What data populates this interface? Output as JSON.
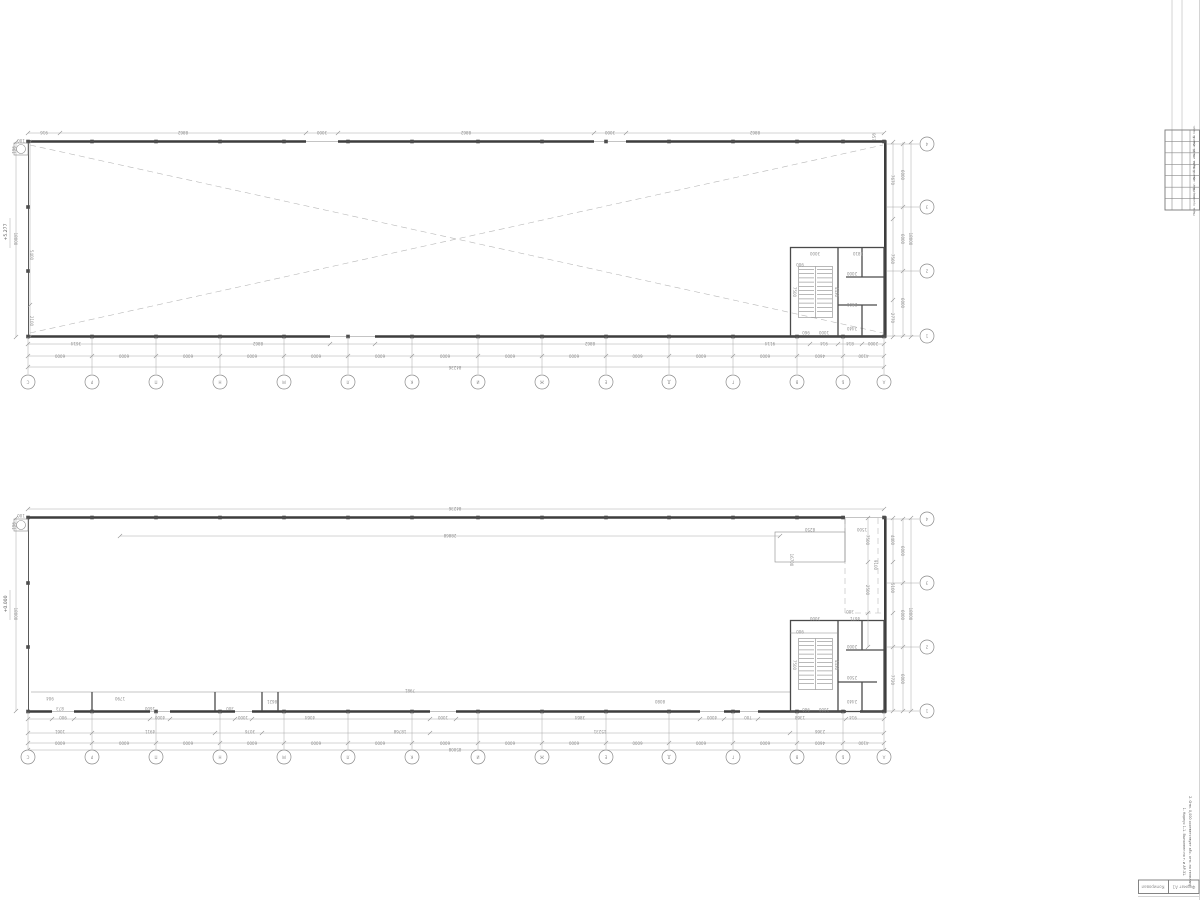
{
  "sheet": {
    "background": "#ffffff",
    "wall_color": "#3d3d3d",
    "dim_color": "#a8a8a8",
    "title": "two-storey industrial building floor plans"
  },
  "axes": {
    "horizontal_labels": [
      "С",
      "Р",
      "П",
      "Н",
      "М",
      "Л",
      "К",
      "И",
      "Ж",
      "Е",
      "Д",
      "Г",
      "В",
      "Б",
      "А"
    ],
    "vertical_labels": [
      "4",
      "3",
      "2",
      "1"
    ]
  },
  "plans": {
    "upper": {
      "name": "plan at elevation +5.277",
      "elevation": "+5.277",
      "bay_dims": [
        "6000",
        "6000",
        "6000",
        "6000",
        "6000",
        "6000",
        "6000",
        "6000",
        "6000",
        "6000",
        "6000",
        "6000",
        "4600",
        "4100"
      ],
      "side_bay_dims": [
        "6000",
        "6000",
        "6000"
      ],
      "total_width": "84236",
      "total_height": "18000",
      "dims": [
        {
          "x": 44,
          "y": 131,
          "t": "916"
        },
        {
          "x": 183,
          "y": 131,
          "t": "8862"
        },
        {
          "x": 322,
          "y": 131,
          "t": "3000"
        },
        {
          "x": 466,
          "y": 131,
          "t": "8862"
        },
        {
          "x": 610,
          "y": 131,
          "t": "3000"
        },
        {
          "x": 755,
          "y": 131,
          "t": "8862"
        },
        {
          "x": 872,
          "y": 137,
          "t": "957",
          "r": 90
        },
        {
          "x": 76,
          "y": 342,
          "t": "3614"
        },
        {
          "x": 258,
          "y": 342,
          "t": "8862"
        },
        {
          "x": 590,
          "y": 342,
          "t": "8862"
        },
        {
          "x": 770,
          "y": 342,
          "t": "9114"
        },
        {
          "x": 824,
          "y": 342,
          "t": "914"
        },
        {
          "x": 850,
          "y": 342,
          "t": "814"
        },
        {
          "x": 873,
          "y": 342,
          "t": "2000"
        },
        {
          "x": 455,
          "y": 366,
          "t": "84236"
        },
        {
          "x": 815,
          "y": 252,
          "t": "3000"
        },
        {
          "x": 858,
          "y": 252,
          "t": "1810"
        },
        {
          "x": 800,
          "y": 263,
          "t": "900"
        },
        {
          "x": 852,
          "y": 272,
          "t": "2000"
        },
        {
          "x": 852,
          "y": 303,
          "t": "2500"
        },
        {
          "x": 852,
          "y": 327,
          "t": "2440"
        },
        {
          "x": 806,
          "y": 331,
          "t": "960"
        },
        {
          "x": 824,
          "y": 331,
          "t": "1000"
        },
        {
          "x": 793,
          "y": 292,
          "t": "7500",
          "r": 90
        },
        {
          "x": 835,
          "y": 292,
          "t": "4430",
          "r": 90
        },
        {
          "x": 14,
          "y": 239,
          "t": "18000",
          "r": 90
        },
        {
          "x": 30,
          "y": 255,
          "t": "5400",
          "r": 90
        },
        {
          "x": 30,
          "y": 321,
          "t": "2100",
          "r": 90
        },
        {
          "x": 891,
          "y": 180,
          "t": "7670",
          "r": 90
        },
        {
          "x": 891,
          "y": 259,
          "t": "7560",
          "r": 90
        },
        {
          "x": 891,
          "y": 318,
          "t": "2770",
          "r": 90
        },
        {
          "x": 901,
          "y": 175,
          "t": "6000",
          "r": 90
        },
        {
          "x": 901,
          "y": 239,
          "t": "6000",
          "r": 90
        },
        {
          "x": 901,
          "y": 303,
          "t": "6000",
          "r": 90
        },
        {
          "x": 909,
          "y": 239,
          "t": "18000",
          "r": 90
        },
        {
          "x": 21,
          "y": 139,
          "t": "100"
        },
        {
          "x": 12,
          "y": 150,
          "t": "961",
          "r": 90
        }
      ]
    },
    "lower": {
      "name": "plan at elevation 0.000",
      "elevation": "+0.000",
      "bay_dims": [
        "6000",
        "6000",
        "6000",
        "6000",
        "6000",
        "6000",
        "6000",
        "6000",
        "6000",
        "6000",
        "6000",
        "6000",
        "4600",
        "4100"
      ],
      "side_bay_dims": [
        "6000",
        "6000",
        "6000"
      ],
      "total_width": "84236",
      "total_height": "18000",
      "dims": [
        {
          "x": 455,
          "y": 507,
          "t": "84236"
        },
        {
          "x": 450,
          "y": 534,
          "t": "28868"
        },
        {
          "x": 410,
          "y": 689,
          "t": "7981"
        },
        {
          "x": 50,
          "y": 697,
          "t": "904"
        },
        {
          "x": 120,
          "y": 697,
          "t": "1790"
        },
        {
          "x": 60,
          "y": 707,
          "t": "873"
        },
        {
          "x": 150,
          "y": 707,
          "t": "1600"
        },
        {
          "x": 230,
          "y": 707,
          "t": "300"
        },
        {
          "x": 272,
          "y": 700,
          "t": "8621"
        },
        {
          "x": 660,
          "y": 700,
          "t": "8080"
        },
        {
          "x": 63,
          "y": 716,
          "t": "900"
        },
        {
          "x": 160,
          "y": 716,
          "t": "4000"
        },
        {
          "x": 243,
          "y": 716,
          "t": "1000"
        },
        {
          "x": 310,
          "y": 716,
          "t": "4064"
        },
        {
          "x": 443,
          "y": 716,
          "t": "1000"
        },
        {
          "x": 580,
          "y": 716,
          "t": "3864"
        },
        {
          "x": 712,
          "y": 716,
          "t": "4000"
        },
        {
          "x": 748,
          "y": 716,
          "t": "700"
        },
        {
          "x": 800,
          "y": 716,
          "t": "1368"
        },
        {
          "x": 853,
          "y": 716,
          "t": "914"
        },
        {
          "x": 60,
          "y": 730,
          "t": "1061"
        },
        {
          "x": 150,
          "y": 730,
          "t": "4911"
        },
        {
          "x": 250,
          "y": 730,
          "t": "3076"
        },
        {
          "x": 400,
          "y": 730,
          "t": "18768"
        },
        {
          "x": 600,
          "y": 730,
          "t": "15231"
        },
        {
          "x": 820,
          "y": 730,
          "t": "2366"
        },
        {
          "x": 455,
          "y": 748,
          "t": "85008"
        },
        {
          "x": 891,
          "y": 540,
          "t": "4400",
          "r": 90
        },
        {
          "x": 891,
          "y": 588,
          "t": "5100",
          "r": 90
        },
        {
          "x": 891,
          "y": 680,
          "t": "7720",
          "r": 90
        },
        {
          "x": 901,
          "y": 551,
          "t": "6000",
          "r": 90
        },
        {
          "x": 901,
          "y": 615,
          "t": "6000",
          "r": 90
        },
        {
          "x": 901,
          "y": 679,
          "t": "6000",
          "r": 90
        },
        {
          "x": 909,
          "y": 614,
          "t": "18000",
          "r": 90
        },
        {
          "x": 866,
          "y": 540,
          "t": "7500",
          "r": 90
        },
        {
          "x": 866,
          "y": 590,
          "t": "2500",
          "r": 90
        },
        {
          "x": 874,
          "y": 565,
          "t": "9100",
          "r": 90
        },
        {
          "x": 810,
          "y": 528,
          "t": "8250"
        },
        {
          "x": 862,
          "y": 528,
          "t": "1500"
        },
        {
          "x": 850,
          "y": 610,
          "t": "300"
        },
        {
          "x": 790,
          "y": 560,
          "t": "16700",
          "r": 90
        },
        {
          "x": 815,
          "y": 617,
          "t": "3000"
        },
        {
          "x": 855,
          "y": 617,
          "t": "4671"
        },
        {
          "x": 800,
          "y": 630,
          "t": "900"
        },
        {
          "x": 852,
          "y": 645,
          "t": "2000"
        },
        {
          "x": 852,
          "y": 676,
          "t": "2500"
        },
        {
          "x": 852,
          "y": 700,
          "t": "2440"
        },
        {
          "x": 806,
          "y": 708,
          "t": "960"
        },
        {
          "x": 824,
          "y": 708,
          "t": "1000"
        },
        {
          "x": 793,
          "y": 665,
          "t": "7500",
          "r": 90
        },
        {
          "x": 835,
          "y": 665,
          "t": "4430",
          "r": 90
        },
        {
          "x": 14,
          "y": 614,
          "t": "18000",
          "r": 90
        },
        {
          "x": 21,
          "y": 514,
          "t": "100"
        },
        {
          "x": 12,
          "y": 526,
          "t": "961",
          "r": 90
        }
      ]
    }
  },
  "title_block": {
    "rows": [
      "Инв. № подл.",
      "Подп. и дата",
      "Взам. инв. №",
      "Инв. № дубл.",
      "Подп. и дата",
      "Спр. №",
      "Перв. примен."
    ],
    "notes": [
      "1. Корпус 1-1. Выполнен по т. и АР-31.",
      "2. Отм. 0,000 соответствует абс. отм. по генплану."
    ],
    "stamp": {
      "left": "Копировал",
      "right": "Формат А1"
    }
  }
}
